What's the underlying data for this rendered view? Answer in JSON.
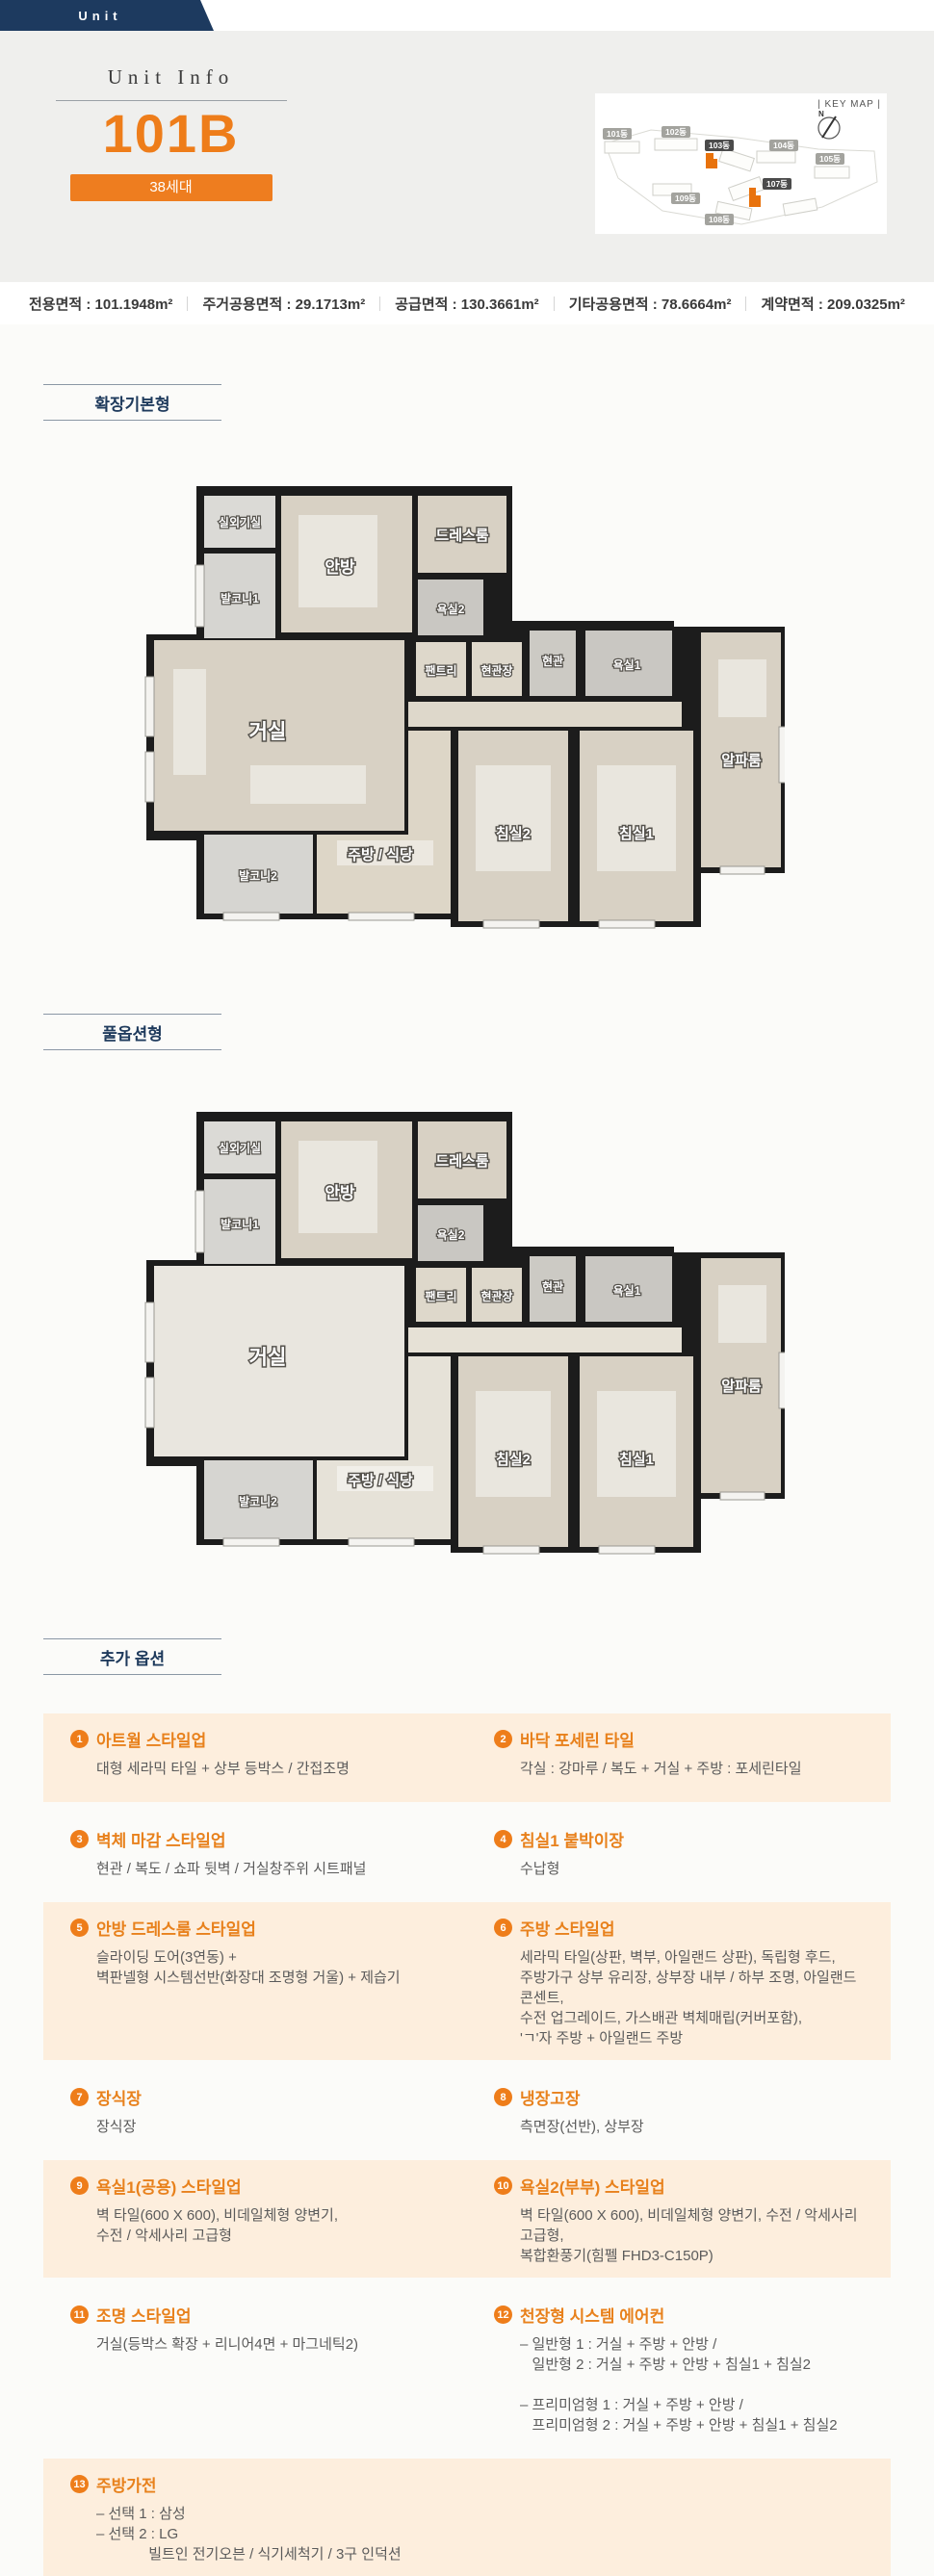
{
  "header": {
    "tab_label": "Unit"
  },
  "hero": {
    "subtitle": "Unit Info",
    "unit_name": "101B",
    "badge": "38세대"
  },
  "keymap": {
    "title": "| KEY MAP |",
    "compass": "N",
    "buildings": {
      "b101": "101동",
      "b102": "102동",
      "b103": "103동",
      "b104": "104동",
      "b105": "105동",
      "b107": "107동",
      "b108": "108동",
      "b109": "109동"
    },
    "highlight_color": "#e8720c"
  },
  "stats": {
    "items": [
      {
        "text": "전용면적 : 101.1948m²"
      },
      {
        "text": "주거공용면적 : 29.1713m²"
      },
      {
        "text": "공급면적 : 130.3661m²"
      },
      {
        "text": "기타공용면적 : 78.6664m²"
      },
      {
        "text": "계약면적 : 209.0325m²"
      }
    ]
  },
  "sections": {
    "basic": "확장기본형",
    "full": "풀옵션형",
    "options": "추가 옵션"
  },
  "rooms": {
    "outdoor_unit": "실외기실",
    "master": "안방",
    "dressroom": "드레스룸",
    "balcony1": "발코니1",
    "bath2": "욕실2",
    "pantry": "팬트리",
    "entry_closet": "현관장",
    "entry": "현관",
    "bath1": "욕실1",
    "living": "거실",
    "alpha": "알파룸",
    "bed2": "침실2",
    "bed1": "침실1",
    "balcony2": "발코니2",
    "kitchen": "주방 / 식당"
  },
  "options": [
    {
      "num": "1",
      "title": "아트월 스타일업",
      "body": "대형 세라믹 타일 + 상부 등박스 / 간접조명"
    },
    {
      "num": "2",
      "title": "바닥 포세린 타일",
      "body": "각실 : 강마루 / 복도 + 거실 + 주방 : 포세린타일"
    },
    {
      "num": "3",
      "title": "벽체 마감 스타일업",
      "body": "현관 / 복도 / 쇼파 뒷벽 / 거실창주위 시트패널"
    },
    {
      "num": "4",
      "title": "침실1 붙박이장",
      "body": "수납형"
    },
    {
      "num": "5",
      "title": "안방 드레스룸 스타일업",
      "body": "슬라이딩 도어(3연동) +\n벽판넬형 시스템선반(화장대 조명형 거울) + 제습기"
    },
    {
      "num": "6",
      "title": "주방 스타일업",
      "body": "세라믹 타일(상판, 벽부, 아일랜드 상판), 독립형 후드,\n주방가구 상부 유리장, 상부장 내부 / 하부 조명, 아일랜드 콘센트,\n수전 업그레이드, 가스배관 벽체매립(커버포함),\n'ㄱ'자 주방 + 아일랜드 주방"
    },
    {
      "num": "7",
      "title": "장식장",
      "body": "장식장"
    },
    {
      "num": "8",
      "title": "냉장고장",
      "body": "측면장(선반), 상부장"
    },
    {
      "num": "9",
      "title": "욕실1(공용) 스타일업",
      "body": "벽 타일(600 X 600), 비데일체형 양변기,\n수전 / 악세사리 고급형"
    },
    {
      "num": "10",
      "title": "욕실2(부부) 스타일업",
      "body": "벽 타일(600 X 600), 비데일체형 양변기, 수전 / 악세사리 고급형,\n복합환풍기(힘펠 FHD3-C150P)"
    },
    {
      "num": "11",
      "title": "조명 스타일업",
      "body": "거실(등박스 확장 + 리니어4면 + 마그네틱2)"
    },
    {
      "num": "12",
      "title": "천장형 시스템 에어컨",
      "body": "– 일반형 1 : 거실 + 주방 + 안방 /\n   일반형 2 : 거실 + 주방 + 안방 + 침실1 + 침실2\n\n– 프리미엄형 1 : 거실 + 주방 + 안방 /\n   프리미엄형 2 : 거실 + 주방 + 안방 + 침실1 + 침실2"
    },
    {
      "num": "13",
      "title": "주방가전",
      "body": "– 선택 1 : 삼성\n– 선택 2 : LG\n             빌트인 전기오븐 / 식기세척기 / 3구 인덕션"
    }
  ],
  "colors": {
    "accent": "#ee7d1a",
    "navy": "#1d3a5f",
    "option_bg": "#fdeedd"
  }
}
